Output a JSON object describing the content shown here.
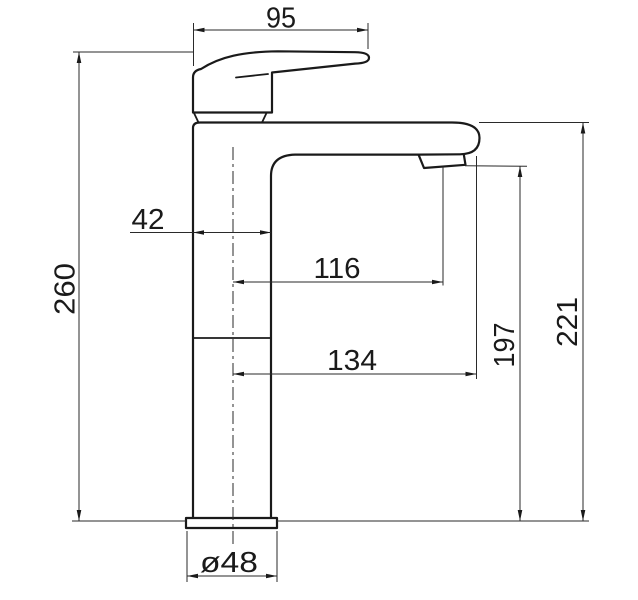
{
  "drawing": {
    "kind": "technical-dimension-drawing",
    "subject": "tall single-lever basin mixer tap, side elevation",
    "dims": {
      "d95": "95",
      "d42": "42",
      "d116": "116",
      "d134": "134",
      "d260": "260",
      "d197": "197",
      "d221": "221",
      "d48": "ø48"
    }
  },
  "colors": {
    "background": "#ffffff",
    "object_line": "#1a1a1a",
    "dimension_line": "#2a2a2a",
    "text": "#1a1a1a"
  }
}
